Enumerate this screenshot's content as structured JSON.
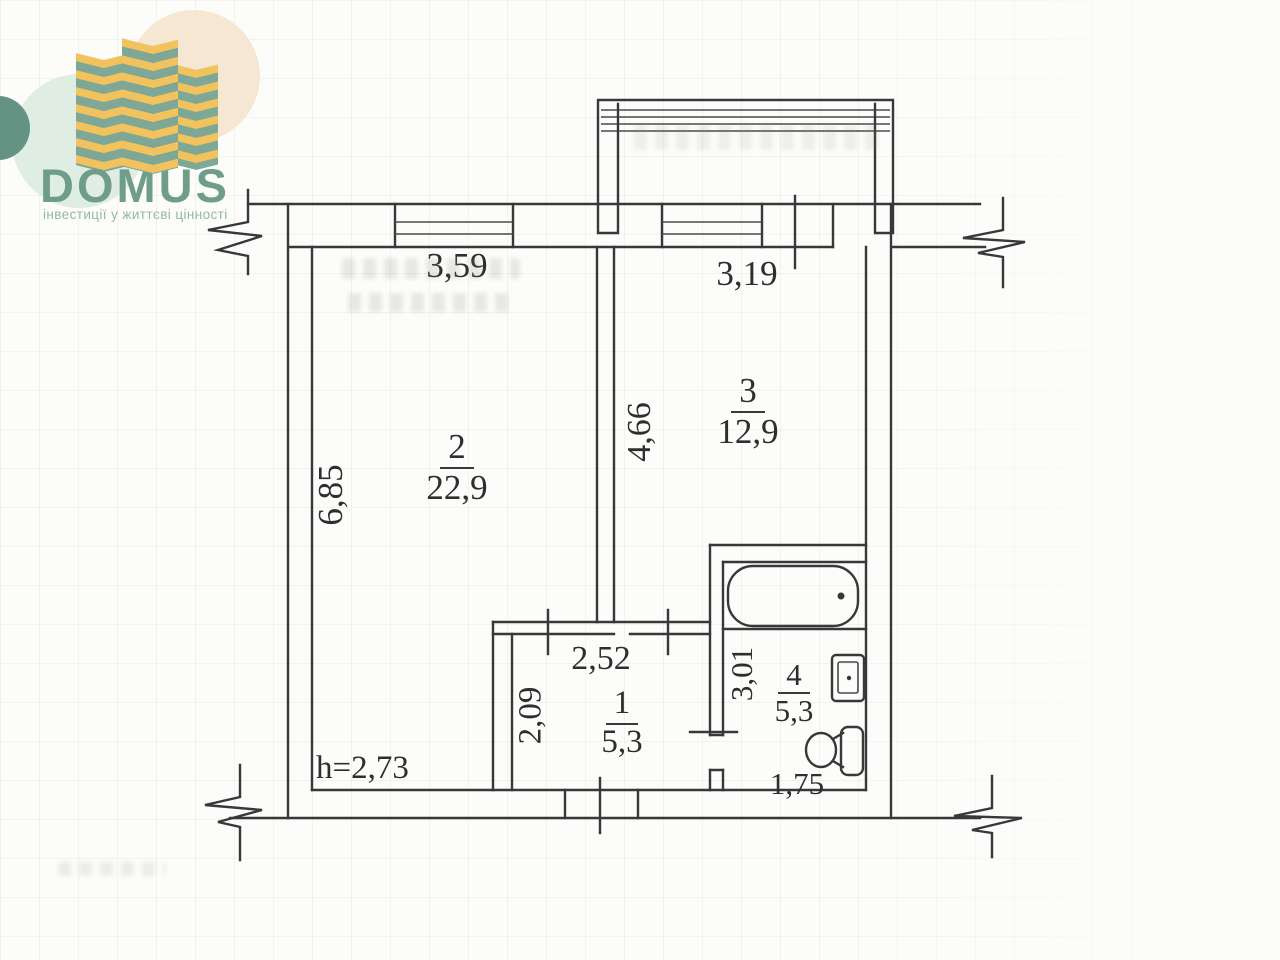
{
  "logo": {
    "brand": "DOMUS",
    "tagline": "інвестиції у життєві цінності",
    "brand_color": "#6f9d8c",
    "tower_green": "#7ea795",
    "tower_yellow": "#f2c35c"
  },
  "plan": {
    "height_note": "h=2,73",
    "rooms": [
      {
        "number": "1",
        "area": "5,3"
      },
      {
        "number": "2",
        "area": "22,9"
      },
      {
        "number": "3",
        "area": "12,9"
      },
      {
        "number": "4",
        "area": "5,3"
      }
    ],
    "dimensions": {
      "room2_width": "3,59",
      "room3_width": "3,19",
      "room2_height": "6,85",
      "room3_height": "4,66",
      "hall_width": "2,52",
      "hall_height": "2,09",
      "bath_height": "3,01",
      "bath_width": "1,75"
    }
  }
}
